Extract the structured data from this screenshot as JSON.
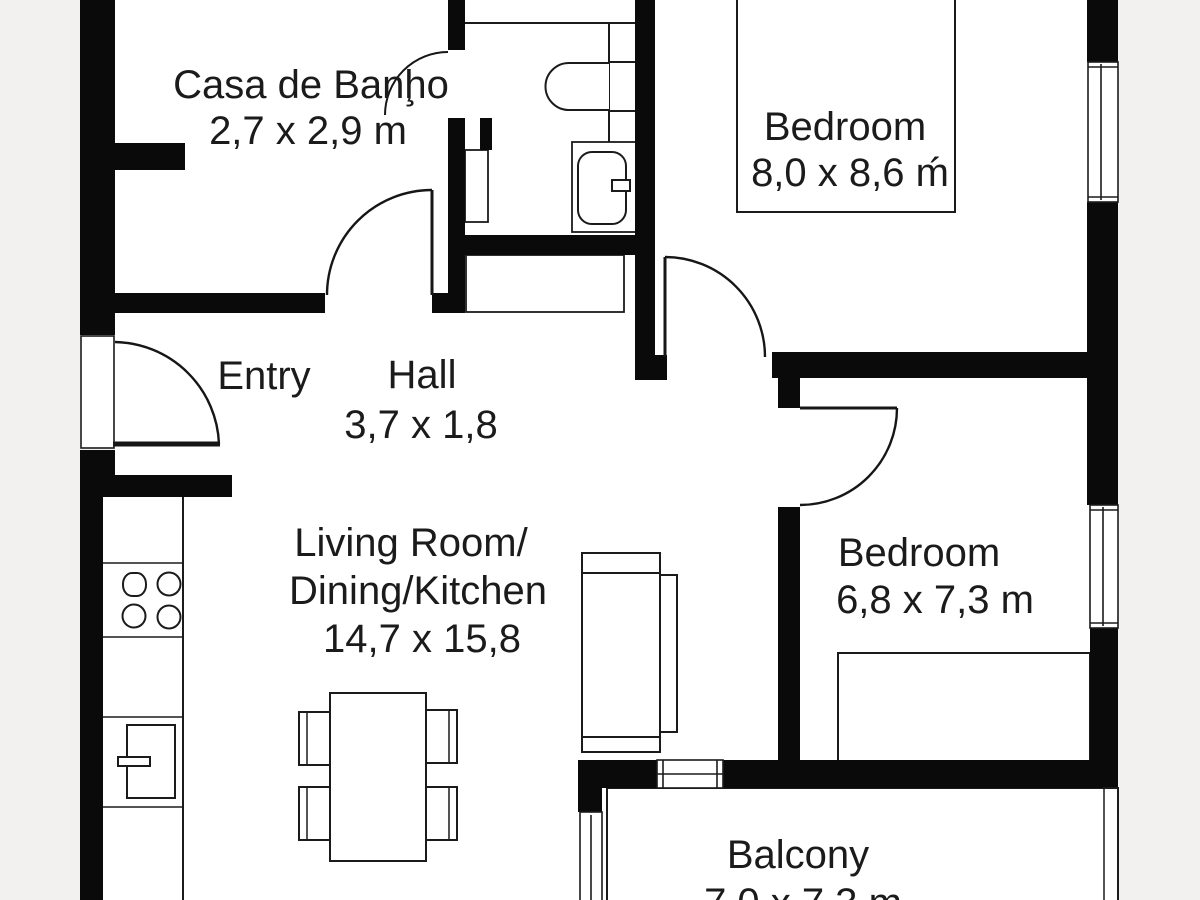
{
  "plan_title": "Apartment floor plan",
  "colors": {
    "background": "#f2f1ef",
    "wall": "#0a0a0a",
    "floor": "#ffffff",
    "line": "#1b1b1b",
    "text": "#1b1b1b"
  },
  "rooms": {
    "bathroom": {
      "name": "Casa de Banḩo",
      "dims": "2,7 x 2,9 m"
    },
    "bedroom1": {
      "name": "Bedroom",
      "dims": "8,0 x 8,6 ḿ"
    },
    "entry": {
      "name": "Entry"
    },
    "hall": {
      "name": "Hall",
      "dims": "3,7 x 1,8"
    },
    "living": {
      "line1": "Living Room/",
      "line2": "Dining/Kitchen",
      "dims": "14,7 x 15,8"
    },
    "bedroom2": {
      "name": "Bedroom",
      "dims": "6,8 x 7,3 m"
    },
    "balcony": {
      "name": "Balcony",
      "dims": "7,0 x 7,3 m"
    }
  }
}
